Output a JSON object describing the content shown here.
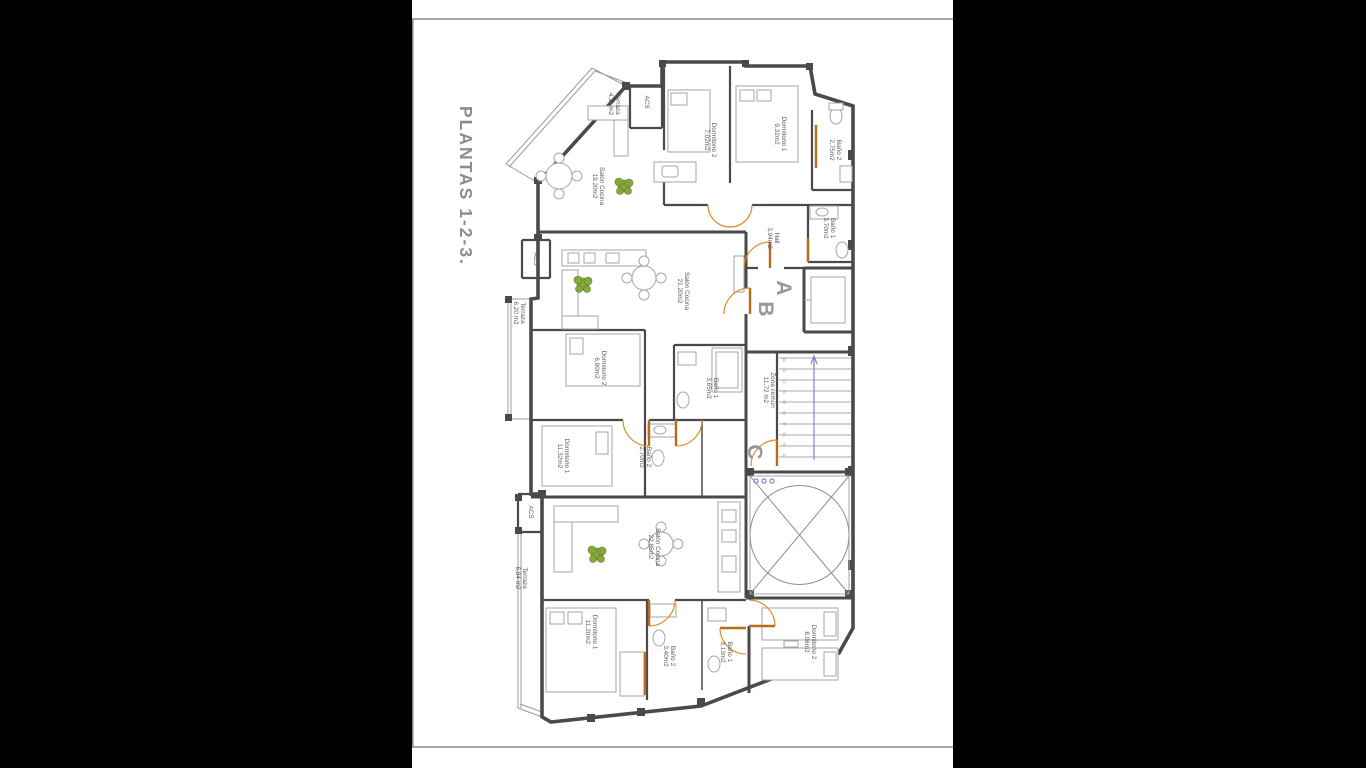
{
  "sheet": {
    "title": "PLANTAS 1-2-3."
  },
  "unit_labels": [
    {
      "label": "A",
      "x": 365,
      "y": 288
    },
    {
      "label": "B",
      "x": 347,
      "y": 309
    },
    {
      "label": "C",
      "x": 336,
      "y": 452
    }
  ],
  "rooms": [
    {
      "name": "Terraza",
      "area": "4,11 m2",
      "x": 203,
      "y": 104
    },
    {
      "name": "ACS",
      "area": "",
      "x": 235,
      "y": 102
    },
    {
      "name": "Dormitorio 2",
      "area": "7,02m2",
      "x": 299,
      "y": 140
    },
    {
      "name": "Dormitorio 1",
      "area": "9,32m2",
      "x": 369,
      "y": 134
    },
    {
      "name": "Baño 2",
      "area": "2,75m2",
      "x": 424,
      "y": 150
    },
    {
      "name": "Baño 1",
      "area": "3,70m2",
      "x": 418,
      "y": 228
    },
    {
      "name": "Hall",
      "area": "3,94m2",
      "x": 362,
      "y": 238
    },
    {
      "name": "Salón Cocina",
      "area": "19,20m2",
      "x": 187,
      "y": 186
    },
    {
      "name": "ACS",
      "area": "",
      "x": 124,
      "y": 259
    },
    {
      "name": "Terraza",
      "area": "6,20 m2",
      "x": 108,
      "y": 313
    },
    {
      "name": "Salón Cocina",
      "area": "21,20m2",
      "x": 272,
      "y": 291
    },
    {
      "name": "Dormitorio 2",
      "area": "6,90m2",
      "x": 189,
      "y": 368
    },
    {
      "name": "Baño 1",
      "area": "3,65m2",
      "x": 301,
      "y": 388
    },
    {
      "name": "Zona común",
      "area": "11,72 m2",
      "x": 358,
      "y": 390
    },
    {
      "name": "Dormitorio 1",
      "area": "11,32m2",
      "x": 152,
      "y": 456
    },
    {
      "name": "Baño 2",
      "area": "2,70m2",
      "x": 234,
      "y": 457
    },
    {
      "name": "ACS",
      "area": "",
      "x": 119,
      "y": 512
    },
    {
      "name": "Terraza",
      "area": "6,84 m2",
      "x": 110,
      "y": 578
    },
    {
      "name": "Salón Cocina",
      "area": "22,85m2",
      "x": 243,
      "y": 547
    },
    {
      "name": "Dormitorio 1",
      "area": "11,20m2",
      "x": 180,
      "y": 632
    },
    {
      "name": "Baño 2",
      "area": "3,40m2",
      "x": 258,
      "y": 656
    },
    {
      "name": "Baño 1",
      "area": "3,13m2",
      "x": 315,
      "y": 652
    },
    {
      "name": "Dormitorio 2",
      "area": "8,06m2",
      "x": 399,
      "y": 642
    }
  ],
  "stairs": {
    "numbers": [
      "01",
      "02",
      "03",
      "04",
      "05",
      "06",
      "07",
      "08",
      "09",
      "10"
    ]
  },
  "colors": {
    "background": "#000000",
    "page": "#ffffff",
    "frame": "#8a8a8a",
    "wall": "#4a4a4c",
    "door": "#e08a28",
    "door_leaf": "#b96b15",
    "furniture": "#a6a6a8",
    "plant": "#86a83c",
    "stair_accent": "#8084cc",
    "label": "#58585a",
    "title": "#8c8c8e"
  }
}
